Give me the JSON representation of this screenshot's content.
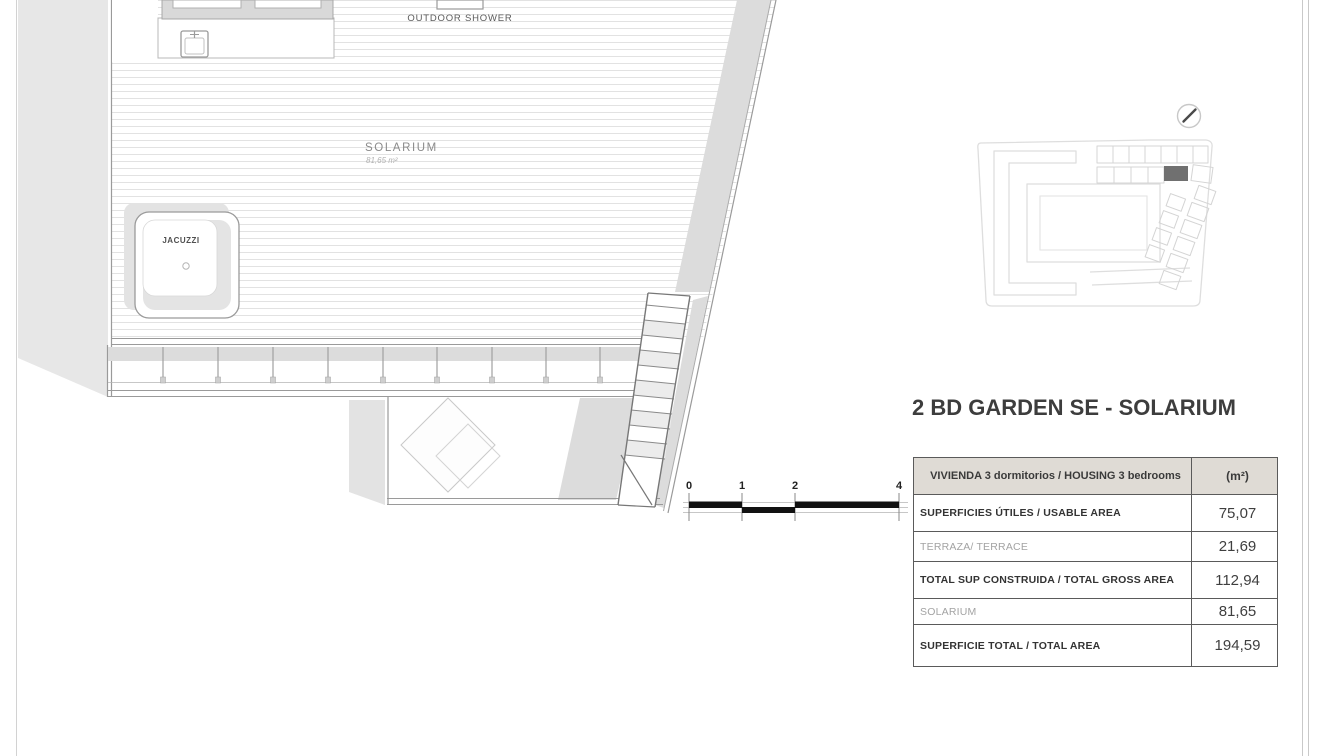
{
  "title": "2 BD GARDEN SE - SOLARIUM",
  "plan": {
    "room_labels": {
      "solarium": "SOLARIUM",
      "solarium_area": "81,65 m²",
      "jacuzzi": "JACUZZI",
      "outdoor_shower": "OUTDOOR SHOWER"
    },
    "scale_bar": {
      "ticks": [
        "0",
        "1",
        "2",
        "4"
      ]
    }
  },
  "site_map": {
    "highlighted_unit_color": "#707070"
  },
  "areas_table": {
    "header": {
      "label": "VIVIENDA 3 dormitorios / HOUSING 3 bedrooms",
      "unit": "(m²)"
    },
    "header_bg": "#dfdbd5",
    "rows": [
      {
        "label": "SUPERFICIES ÚTILES / USABLE AREA",
        "value": "75,07",
        "style": "bold"
      },
      {
        "label": "TERRAZA/ TERRACE",
        "value": "21,69",
        "style": "light"
      },
      {
        "label": "TOTAL SUP CONSTRUIDA / TOTAL GROSS AREA",
        "value": "112,94",
        "style": "bold"
      },
      {
        "label": "SOLARIUM",
        "value": "81,65",
        "style": "light"
      },
      {
        "label": "SUPERFICIE TOTAL / TOTAL  AREA",
        "value": "194,59",
        "style": "bold"
      }
    ]
  }
}
